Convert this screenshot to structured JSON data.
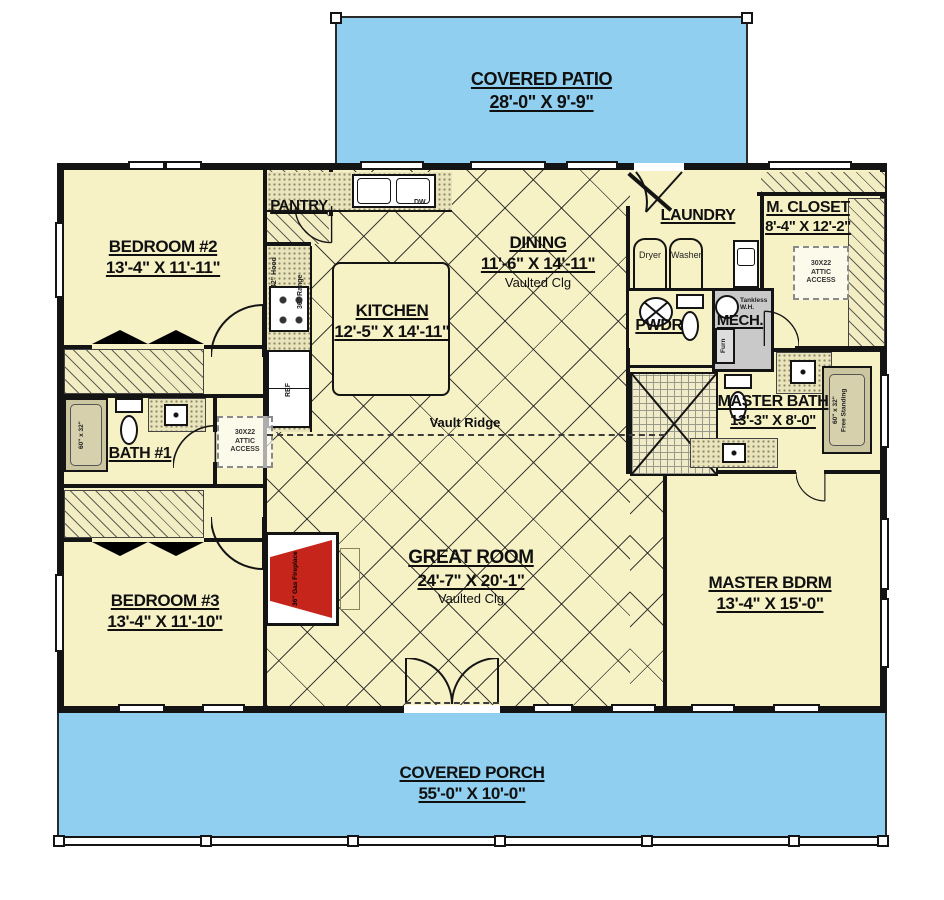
{
  "rooms": {
    "patio": {
      "label": "COVERED PATIO",
      "dims": "28'-0\" X 9'-9\""
    },
    "porch": {
      "label": "COVERED PORCH",
      "dims": "55'-0\" X 10'-0\""
    },
    "bedroom2": {
      "label": "BEDROOM #2",
      "dims": "13'-4\" X 11'-11\""
    },
    "bath1": {
      "label": "BATH #1"
    },
    "bedroom3": {
      "label": "BEDROOM #3",
      "dims": "13'-4\" X 11'-10\""
    },
    "pantry": {
      "label": "PANTRY"
    },
    "kitchen": {
      "label": "KITCHEN",
      "dims": "12'-5\" X 14'-11\""
    },
    "dining": {
      "label": "DINING",
      "dims": "11'-6\" X 14'-11\"",
      "note": "Vaulted Clg"
    },
    "great": {
      "label": "GREAT ROOM",
      "dims": "24'-7\" X 20'-1\"",
      "note": "Vaulted Clg"
    },
    "laundry": {
      "label": "LAUNDRY"
    },
    "mcloset": {
      "label": "M. CLOSET",
      "dims": "8'-4\" X 12'-2\""
    },
    "pwdr": {
      "label": "PWDR"
    },
    "mech": {
      "label": "MECH."
    },
    "mbath": {
      "label": "MASTER BATH",
      "dims": "13'-3\" X 8'-0\""
    },
    "mbdrm": {
      "label": "MASTER BDRM",
      "dims": "13'-4\" X 15'-0\""
    }
  },
  "fixtures": {
    "dryer": "Dryer",
    "washer": "Washer",
    "dw": "DW",
    "ref": "REF",
    "hood": "42\" Hood",
    "range": "36\" Range",
    "tankless": "Tankless\nW.H.",
    "furn": "Furn",
    "tub": "60\" x 32\"",
    "freetub": "60\" x 32\"\nFree Standing",
    "fireplace": "36\" Gas Fireplace",
    "attic": "30X22\nATTIC\nACCESS"
  },
  "annotations": {
    "vault_ridge": "Vault Ridge"
  },
  "colors": {
    "floor": "#F6F2C6",
    "outdoor": "#90CFEF",
    "wall": "#141414",
    "fireplace_red": "#C5251B",
    "mech_gray": "#C9C9C9"
  }
}
